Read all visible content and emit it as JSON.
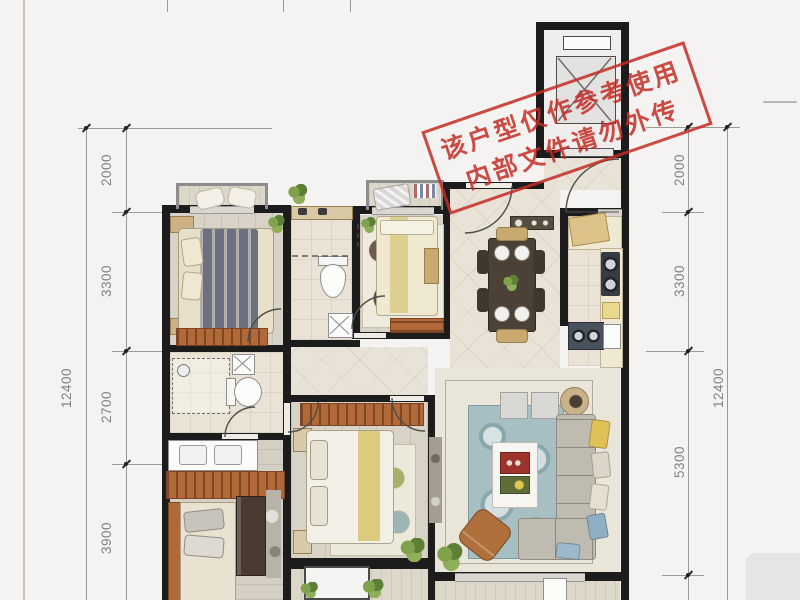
{
  "watermark": {
    "line1": "该户型仅作参考使用",
    "line2": "内部文件请勿外传",
    "color": "#c32c26"
  },
  "dimensions": {
    "left": {
      "segments": [
        "2000",
        "3300",
        "2700",
        "3900"
      ],
      "total": "12400"
    },
    "right": {
      "segments": [
        "2000",
        "3300",
        "5300"
      ],
      "total": "12400"
    }
  },
  "colors": {
    "wall": "#1c1c1c",
    "dimension_text": "#828282",
    "wardrobe_wood": "#b2693a",
    "living_rug_teal": "#9fb9bd",
    "floor_tile": "#e8e3d6",
    "watermark_red": "#c32c26"
  },
  "icons": {
    "elevator": "elevator-shaft-x",
    "doors": "door-swing-arc",
    "shower": "dashed-shower-enclosure"
  }
}
